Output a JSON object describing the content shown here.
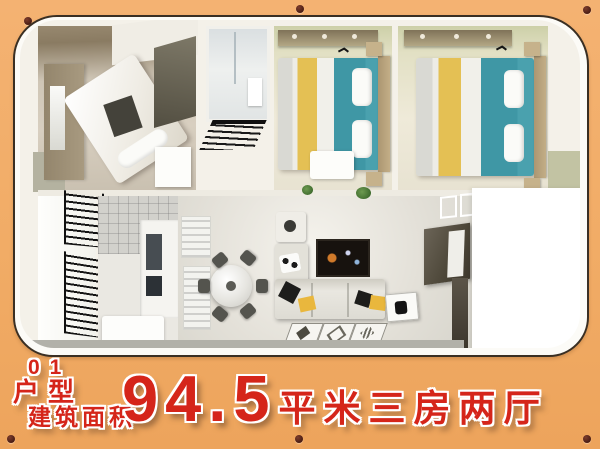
{
  "banner": {
    "unit_number": "01",
    "unit_type_label": "户型",
    "area_label": "建筑面积",
    "area_value": "94.5",
    "area_unit_and_layout": "平米三房两厅"
  },
  "colors": {
    "frame_orange": "#f1ac66",
    "panel_border": "#3a2f23",
    "screw_brown": "#4a1d14",
    "text_red": "#d5251a",
    "text_outline": "#ffffff",
    "bed_teal": "#3f97a5",
    "bed_yellow": "#e4c054",
    "wood_tan": "#ab9671",
    "wall_white": "#f4f1e9"
  }
}
